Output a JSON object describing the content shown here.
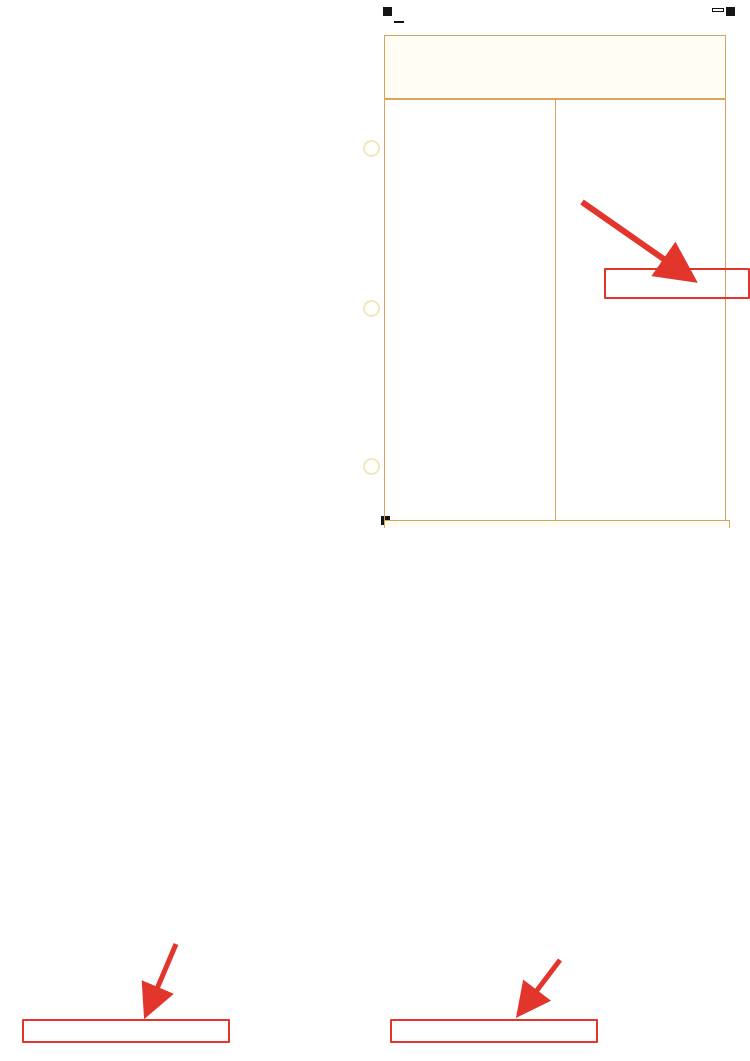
{
  "page": {
    "big_label": "振替額"
  },
  "annotations": {
    "income_label": "所得税",
    "general_line1": "消費税",
    "general_line2": "(一般)",
    "simple_line1": "消費税",
    "simple_line2": "(簡易)",
    "color": "#e2352b"
  },
  "income": {
    "code": "FA2202",
    "title": {
      "to": "税務署長",
      "date": "令和　年　月　日",
      "era": "令和",
      "era_box": "0",
      "mid": "年分の",
      "tax1": "所得税及び",
      "tax2": "復興特別所得税",
      "no": "の",
      "end": "申告書"
    },
    "unit_note": "（単位は円）",
    "header_rows": [
      [
        "納税地",
        "〒　　－",
        "個人番号",
        "生年月日"
      ],
      [
        "現在の住所又は居所・事業所など",
        "フリガナ",
        "氏名",
        ""
      ],
      [
        "令和5年1月1日の住所",
        "職業",
        "屋号・雅号",
        "世帯主の氏名",
        "世帯主との続柄"
      ],
      [
        "種類",
        "青色",
        "分離",
        "国出",
        "損失",
        "修正",
        "特農の表示",
        "整理番号",
        "電話番号"
      ]
    ],
    "left_sections": [
      {
        "name": "収入金額等",
        "color": "#2f9a4d",
        "rows": [
          [
            "事業　営業等",
            "ア",
            "",
            ""
          ],
          [
            "事業　農業",
            "イ",
            "",
            ""
          ],
          [
            "不動産",
            "ウ",
            "",
            ""
          ],
          [
            "配当",
            "エ",
            "",
            ""
          ],
          [
            "給与",
            "オ",
            "",
            ""
          ],
          [
            "雑　公的年金等",
            "カ",
            "",
            ""
          ],
          [
            "雑　業務",
            "キ",
            "",
            ""
          ],
          [
            "雑　その他",
            "ク",
            "",
            ""
          ],
          [
            "総合譲渡　短期",
            "ケ",
            "",
            ""
          ],
          [
            "総合譲渡　長期",
            "コ",
            "",
            ""
          ],
          [
            "一時",
            "サ",
            "",
            ""
          ]
        ]
      },
      {
        "name": "所得金額等",
        "color": "#85c9e8",
        "rows": [
          [
            "事業　営業等",
            "①",
            "",
            ""
          ],
          [
            "農業",
            "②",
            "",
            ""
          ],
          [
            "不動産",
            "③",
            "",
            ""
          ],
          [
            "利子",
            "④",
            "",
            ""
          ],
          [
            "配当",
            "⑤",
            "",
            ""
          ],
          [
            "給与",
            "⑥",
            "",
            ""
          ],
          [
            "雑　公的年金等",
            "⑦",
            "",
            ""
          ],
          [
            "雑　業務",
            "⑧",
            "",
            ""
          ],
          [
            "雑　その他",
            "⑨",
            "",
            ""
          ],
          [
            "⑦から⑨までの計",
            "⑩",
            "",
            ""
          ],
          [
            "総合譲渡・一時",
            "⑪",
            "",
            ""
          ],
          [
            "合計（①＋②＋③＋⑥＋⑩＋⑪）",
            "⑫",
            "",
            ""
          ]
        ]
      },
      {
        "name": "所得から差し引かれる金額",
        "color": "#bd3360",
        "rows": [
          [
            "社会保険料控除",
            "⑬",
            "",
            ""
          ],
          [
            "小規模企業共済等掛金控除",
            "⑭",
            "",
            ""
          ],
          [
            "生命保険料控除",
            "⑮",
            "",
            ""
          ],
          [
            "地震保険料控除",
            "⑯",
            "",
            ""
          ],
          [
            "寡婦、ひとり親控除",
            "⑰⑱",
            "0000",
            ""
          ],
          [
            "勤労学生、障害者控除",
            "⑲⑳",
            "0000",
            ""
          ],
          [
            "配偶者（特別）控除",
            "㉑㉒",
            "0000",
            ""
          ],
          [
            "扶養控除",
            "㉓",
            "0000",
            ""
          ],
          [
            "基礎控除",
            "㉔",
            "0000",
            ""
          ],
          [
            "⑬から㉔までの計",
            "㉕",
            "",
            ""
          ],
          [
            "雑損控除",
            "㉖",
            "",
            ""
          ],
          [
            "医療費控除",
            "㉗",
            "",
            ""
          ],
          [
            "寄附金控除",
            "㉘",
            "",
            ""
          ],
          [
            "合計（㉕＋㉖＋㉗＋㉘）",
            "㉙",
            "",
            ""
          ]
        ]
      }
    ],
    "right_sections": [
      {
        "name": "税金の計算",
        "color": "#453c8c",
        "rows": [
          [
            "課税される所得金額（⑫－㉙）又は第三表",
            "㉚",
            "000",
            ""
          ],
          [
            "上の㉚に対する税額 又は第三表の㉝",
            "㉛",
            "",
            ""
          ],
          [
            "配当控除",
            "㉜",
            "",
            ""
          ],
          [
            "区分",
            "㉝",
            "",
            ""
          ],
          [
            "（特定増改築等）住宅借入金等特別控除",
            "㉞",
            "00",
            ""
          ],
          [
            "政党等寄附金等特別控除",
            "㉟㊱㊲",
            "",
            ""
          ],
          [
            "住宅耐震改修特別控除等",
            "㊳㊴㊵",
            "",
            ""
          ],
          [
            "差引所得税額",
            "㊶",
            "",
            "y"
          ],
          [
            "災害減免額",
            "㊷",
            "",
            ""
          ],
          [
            "再差引所得税額（基準所得税額）",
            "㊸",
            "",
            "y"
          ],
          [
            "復興特別所得税額（㊸×2.1％）",
            "㊹",
            "",
            "y"
          ],
          [
            "所得税及び復興特別所得税の額",
            "㊺",
            "",
            "y"
          ],
          [
            "外国税額控除等　区分",
            "㊻",
            "",
            ""
          ],
          [
            "源泉徴収税額",
            "㊼",
            "",
            ""
          ],
          [
            "申告納税額（㊺－㊻－㊼）",
            "㊽",
            "",
            ""
          ],
          [
            "予定納税額（第1期分・第2期分）",
            "㊾",
            "",
            ""
          ],
          [
            "第3期分の税額　納める税金",
            "㊿",
            "00",
            "t"
          ],
          [
            "還付される税金",
            "51",
            "",
            ""
          ],
          [
            "修正前の第3期分の税額",
            "52",
            "",
            ""
          ],
          [
            "第3期分の税額の増加額",
            "53",
            "00",
            ""
          ]
        ]
      },
      {
        "name": "その他",
        "color": "#e57fa5",
        "rows": [
          [
            "公的年金等以外の合計所得金額",
            "54",
            "",
            ""
          ],
          [
            "配偶者の合計所得金額",
            "55",
            "",
            ""
          ],
          [
            "専従者給与（控除）額の合計額",
            "56",
            "",
            ""
          ],
          [
            "青色申告特別控除額",
            "57",
            "",
            ""
          ],
          [
            "雑所得・一時所得等の源泉徴収税額の合計額",
            "58",
            "",
            ""
          ],
          [
            "未納付の源泉徴収税額",
            "59",
            "",
            ""
          ],
          [
            "本年分で差し引く繰越損失額",
            "60",
            "",
            ""
          ],
          [
            "平均課税対象金額",
            "61",
            "",
            ""
          ],
          [
            "変動・臨時所得金額　区分",
            "62",
            "",
            ""
          ]
        ]
      },
      {
        "name": "延納の届出",
        "color": "#3f9e4e",
        "rows": [
          [
            "申告期限までに納付する金額",
            "63",
            "00",
            ""
          ],
          [
            "延納届出額",
            "64",
            "000",
            ""
          ]
        ]
      },
      {
        "name": "還付される税金の受取場所",
        "color": "#85c9e8",
        "rows": [
          [
            "銀行　金庫・組合　農協・漁協",
            "",
            "",
            ""
          ],
          [
            "本店・支店　出張所　本所・支所　郵便局名等",
            "",
            "",
            ""
          ],
          [
            "預金　普通　当座　納税準備　貯蓄",
            "",
            "",
            ""
          ],
          [
            "口座番号・記号番号",
            "",
            "",
            ""
          ],
          [
            "公金受取口座登録の同意　公金受取口座の利用",
            "",
            "",
            ""
          ]
        ]
      },
      {
        "name": "整理欄",
        "color": "#b9b9b9",
        "rows": [
          [
            "区分　A　B　C　D　E　F　G　H　I　J　K",
            "",
            "",
            ""
          ],
          [
            "異動　管理　補完　確認",
            "",
            "",
            ""
          ]
        ]
      }
    ],
    "bottom_row": "整理欄　名簿",
    "side": {
      "sheet": "第一表",
      "note": "（令和四年分以降用）",
      "reminder": "㊵〜㊸の又は㊹の記入をお忘れなく。"
    }
  },
  "ctax_general": {
    "binding_note": "この用紙はとじこまないでください。",
    "form_code": "GK0304",
    "style_no": "第3-(1)号様式",
    "left_note": "この申告書は機械で読み取りますので黒のボールペン等で記入してください。",
    "head_left": [
      [
        "令和　年　月　日",
        "税務署長殿"
      ],
      [
        "納税地",
        "（電話番号　　－　　－　　）"
      ],
      [
        "（フリガナ）",
        ""
      ],
      [
        "名称又は屋号",
        ""
      ],
      [
        "個人番号又は法人番号",
        "個人番号の記載に当たっては左端を空欄とし、ここから記載してください。"
      ],
      [
        "（フリガナ）",
        ""
      ],
      [
        "代表者氏名又は氏名",
        ""
      ]
    ],
    "head_band": "税務署処理欄",
    "head_right": [
      [
        "一連番号",
        ""
      ],
      [
        "整理番号",
        ""
      ],
      [
        "申告年月日",
        "令和　年　月　日"
      ],
      [
        "申告区分",
        "指導等　庁指定　局指定"
      ],
      [
        "通信日付印　確認印",
        ""
      ],
      [
        "確認書類",
        "個人番号カード　通知カード・運転免許証　その他"
      ],
      [
        "身元確認",
        "済　未済"
      ]
    ],
    "period": {
      "from": "自 令和　年　月　日",
      "to": "至 令和　年　月　日",
      "title1": "課税期間分の消費税及び地方",
      "title2": "消費税の（　　　　）申告書",
      "mid_label": "中間申告の場合の対象期間",
      "mid_from": "自 令和　年　月　日",
      "mid_to": "至 令和　年　月　日"
    },
    "calc_title": "この申告書による消費税の税額の計算",
    "rows": [
      [
        "課税標準額",
        "①",
        "000"
      ],
      [
        "消費税額",
        "②",
        ""
      ],
      [
        "控除過大調整税額",
        "③",
        ""
      ],
      [
        "控除税額　控除対象仕入税額",
        "④",
        ""
      ],
      [
        "返還等対価に係る税額",
        "⑤",
        ""
      ],
      [
        "貸倒れに係る税額",
        "⑥",
        ""
      ],
      [
        "控除税額小計（④＋⑤＋⑥）",
        "⑦",
        ""
      ],
      [
        "控除不足還付税額（⑦－②－③）",
        "⑧",
        ""
      ],
      [
        "差引税額（②＋③－⑦）",
        "⑨",
        "00"
      ],
      [
        "中間納付税額",
        "⑩",
        "00"
      ],
      [
        "納付税額（⑨－⑩）",
        "⑪",
        "00"
      ],
      [
        "中間納付還付税額（⑩－⑨）",
        "⑫",
        "00"
      ],
      [
        "修正申告の場合　既確定税額",
        "⑬",
        ""
      ],
      [
        "差引納付税額",
        "⑭",
        "00"
      ],
      [
        "課税売上割合　課税資産の譲渡等の対価の額",
        "⑮",
        ""
      ],
      [
        "資産の譲渡等の対価の額",
        "⑯",
        ""
      ]
    ],
    "local_title": "この申告書による地方消費税の税額の計算",
    "local_rows": [
      [
        "地方消費税の課税標準となる消費税額　控除不足還付税額",
        "⑰",
        ""
      ],
      [
        "差引税額",
        "⑱",
        "00"
      ],
      [
        "譲渡割額　還付額",
        "⑲",
        ""
      ],
      [
        "納付額",
        "⑳",
        "00"
      ],
      [
        "中間納付譲渡割額",
        "㉑",
        "00"
      ],
      [
        "納付譲渡割額（⑳－㉑）",
        "㉒",
        "00"
      ],
      [
        "中間納付還付譲渡割額（㉑－⑳）",
        "㉓",
        "00"
      ],
      [
        "修正申告の場合　既確定譲渡割額",
        "㉔",
        ""
      ],
      [
        "差引納付譲渡割額",
        "㉕",
        "00"
      ]
    ],
    "total_row": [
      "消費税及び地方消費税の合計（納付又は還付）税額",
      "㉖"
    ],
    "foot_note": "還付となる場合はマイナス「－」を付してください。",
    "right": {
      "fuki_rows": [
        "割賦基準の適用",
        "延払基準等の適用",
        "工事進行基準の適用",
        "現金主義会計の適用",
        "課税標準額に対する消費税額の計算の特例の適用"
      ],
      "have": "有",
      "none": "無",
      "method_title": "控除税額の計算方法",
      "method_rows": [
        [
          "課税売上高5億円超又は課税売上割合95％未満",
          "個別対応方式"
        ],
        [
          "",
          "一括比例配分方式"
        ],
        [
          "上記以外",
          "全額控除"
        ]
      ],
      "kijun_label": "基準期間の課税売上高",
      "kijun_unit": "千円",
      "bank_title": "還付を受けようとする金融機関等",
      "bank_rows": [
        "銀行　金庫・組合　農協・漁協",
        "本店・支店　出張所　本所・支所",
        "預金　口座番号",
        "ゆうちょ銀行の貯金記号番号",
        "郵便局名等"
      ],
      "seiri": "※税務署整理欄",
      "zeirishi": "税理士署名",
      "tel": "（電話番号　　－　　－　　）",
      "law30": "税理士法第30条の書面提出有",
      "law33": "税理士法第33条の2の書面提出有"
    },
    "side": {
      "sheet": "第一表",
      "note": "（一般用）"
    }
  },
  "ctax_simple": {
    "binding_note": "この用紙はとじこまないでください。",
    "form_code": "GK0405",
    "style_no": "第3-(2)号様式",
    "left_note": "この申告書は機械で読み取りますので黒のボールペン等で記入してください。",
    "head_left": [
      [
        "令和　年　月　日",
        "税務署長殿"
      ],
      [
        "納税地",
        "（電話番号　　－　　－　　）"
      ],
      [
        "（フリガナ）",
        ""
      ],
      [
        "名称又は屋号",
        ""
      ],
      [
        "個人番号又は法人番号",
        "個人番号の記載に当たっては左端を空欄とし、ここから記載してください。"
      ],
      [
        "（フリガナ）",
        ""
      ],
      [
        "代表者氏名又は氏名",
        ""
      ]
    ],
    "head_band": "税務署処理欄",
    "head_right": [
      [
        "一連番号",
        ""
      ],
      [
        "整理番号",
        ""
      ],
      [
        "申告年月日",
        "令和　年　月　日"
      ],
      [
        "申告区分",
        "指導等　庁指定　局指定"
      ],
      [
        "通信日付印　確認印",
        ""
      ],
      [
        "確認書類",
        "個人番号カード　通知カード・運転免許証　その他"
      ],
      [
        "身元確認",
        "済　未済"
      ]
    ],
    "period": {
      "from": "自 令和　年　月　日",
      "to": "至 令和　年　月　日",
      "title1": "課税期間分の消費税及び地方",
      "title2": "消費税の（　　　　）申告書",
      "mid_label": "中間申告の場合の対象期間",
      "mid_from": "自 令和　年　月　日",
      "mid_to": "至 令和　年　月　日"
    },
    "calc_title": "この申告書による消費税の税額の計算",
    "rows": [
      [
        "課税標準額",
        "①",
        "000"
      ],
      [
        "消費税額",
        "②",
        ""
      ],
      [
        "貸倒回収に係る消費税額",
        "③",
        ""
      ],
      [
        "控除税額　控除対象仕入税額",
        "④",
        ""
      ],
      [
        "返還等対価に係る税額",
        "⑤",
        ""
      ],
      [
        "貸倒れに係る税額",
        "⑥",
        ""
      ],
      [
        "控除税額小計（④＋⑤＋⑥）",
        "⑦",
        ""
      ],
      [
        "控除不足還付税額（⑦－②－③）",
        "⑧",
        ""
      ],
      [
        "差引税額（②＋③－⑦）",
        "⑨",
        "00"
      ],
      [
        "中間納付税額",
        "⑩",
        "00"
      ],
      [
        "納付税額（⑨－⑩）",
        "⑪",
        "00"
      ],
      [
        "中間納付還付税額（⑩－⑨）",
        "⑫",
        "00"
      ],
      [
        "修正申告の場合　既確定税額",
        "⑬",
        ""
      ],
      [
        "差引納付税額",
        "⑭",
        "00"
      ],
      [
        "この課税期間の課税売上高",
        "⑮",
        ""
      ],
      [
        "基準期間の課税売上高",
        "⑯",
        ""
      ]
    ],
    "local_title": "この申告書による地方消費税の税額の計算",
    "local_rows": [
      [
        "地方消費税の課税標準となる消費税額　控除不足還付税額",
        "⑰",
        ""
      ],
      [
        "差引税額",
        "⑱",
        "00"
      ],
      [
        "譲渡割額　還付額",
        "⑲",
        ""
      ],
      [
        "納付額",
        "⑳",
        "00"
      ],
      [
        "中間納付譲渡割額",
        "㉑",
        "00"
      ],
      [
        "納付譲渡割額（⑳－㉑）",
        "㉒",
        "00"
      ],
      [
        "中間納付還付譲渡割額（㉑－⑳）",
        "㉓",
        "00"
      ],
      [
        "修正申告の場合　既確定譲渡割額",
        "㉔",
        ""
      ],
      [
        "差引納付譲渡割額",
        "㉕",
        "00"
      ]
    ],
    "total_row": [
      "消費税及び地方消費税の合計（納付又は還付）税額",
      "㉖"
    ],
    "foot_note": "還付となる場合はマイナス「－」を付してください。",
    "right": {
      "fuki_rows": [
        "割賦基準の適用",
        "延払基準等の適用",
        "工事進行基準の適用",
        "現金主義会計の適用",
        "課税標準額に対する消費税額の計算の特例の適用"
      ],
      "have": "有",
      "none": "無",
      "biz_title": "事業区分",
      "biz_cols": [
        "区分",
        "課税売上高（免税売上高を除く）",
        "売上割合 ％"
      ],
      "biz_rows": [
        "第1種",
        "第2種",
        "第3種",
        "第4種",
        "第5種",
        "第6種"
      ],
      "tokurei": "特例計算適用（令57③）",
      "bank_title": "還付を受けようとする金融機関等",
      "bank_rows": [
        "銀行　金庫・組合　農協・漁協",
        "本店・支店　出張所　本所・支所",
        "預金　口座番号",
        "ゆうちょ銀行の貯金記号番号",
        "郵便局名等"
      ],
      "seiri": "※税務署整理欄",
      "zeirishi": "税理士署名",
      "tel": "（電話番号　　－　　－　　）",
      "law30": "税理士法第30条の書面提出有",
      "law33": "税理士法第33条の2の書面提出有"
    },
    "side": {
      "sheet": "第一表",
      "note": "（簡易課税用）"
    }
  }
}
